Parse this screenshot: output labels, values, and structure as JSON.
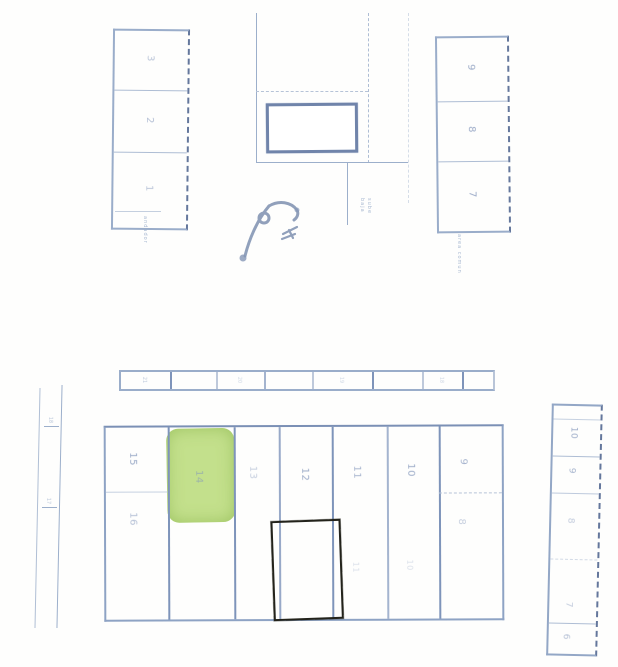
{
  "document": {
    "type": "scanned site plan",
    "background": "#fefefd"
  },
  "colors": {
    "pen_line": "#93a7c6",
    "pen_dark": "#64779c",
    "label_blue": "#8497bb",
    "highlight_green": "#c3e08c",
    "sketch_ink": "#23231b",
    "kiosk_border": "#7084aa"
  },
  "top_left_block": {
    "cells": [
      "3",
      "2",
      "1"
    ]
  },
  "top_right_block": {
    "cells": [
      "9",
      "8",
      "7"
    ]
  },
  "center_area": {
    "annotation_left": "andador",
    "annotation_stairs_line1": "sube",
    "annotation_stairs_line2": "baja",
    "annotation_right": "area comun"
  },
  "left_road": {
    "ticks": [
      "18",
      "17"
    ]
  },
  "top_strip": {
    "cells": [
      "21",
      "",
      "20",
      "",
      "19",
      "",
      "18",
      ""
    ]
  },
  "main_grid": {
    "col1": {
      "top": "15",
      "bottom": "16"
    },
    "green_label": "14",
    "cols": [
      "13",
      "12",
      "11",
      "10"
    ],
    "col_last": {
      "top": "9",
      "bottom": "8"
    },
    "faint": [
      "11",
      "10"
    ]
  },
  "right_strip": {
    "cells": [
      "10",
      "9",
      "8",
      "7",
      "6"
    ]
  }
}
